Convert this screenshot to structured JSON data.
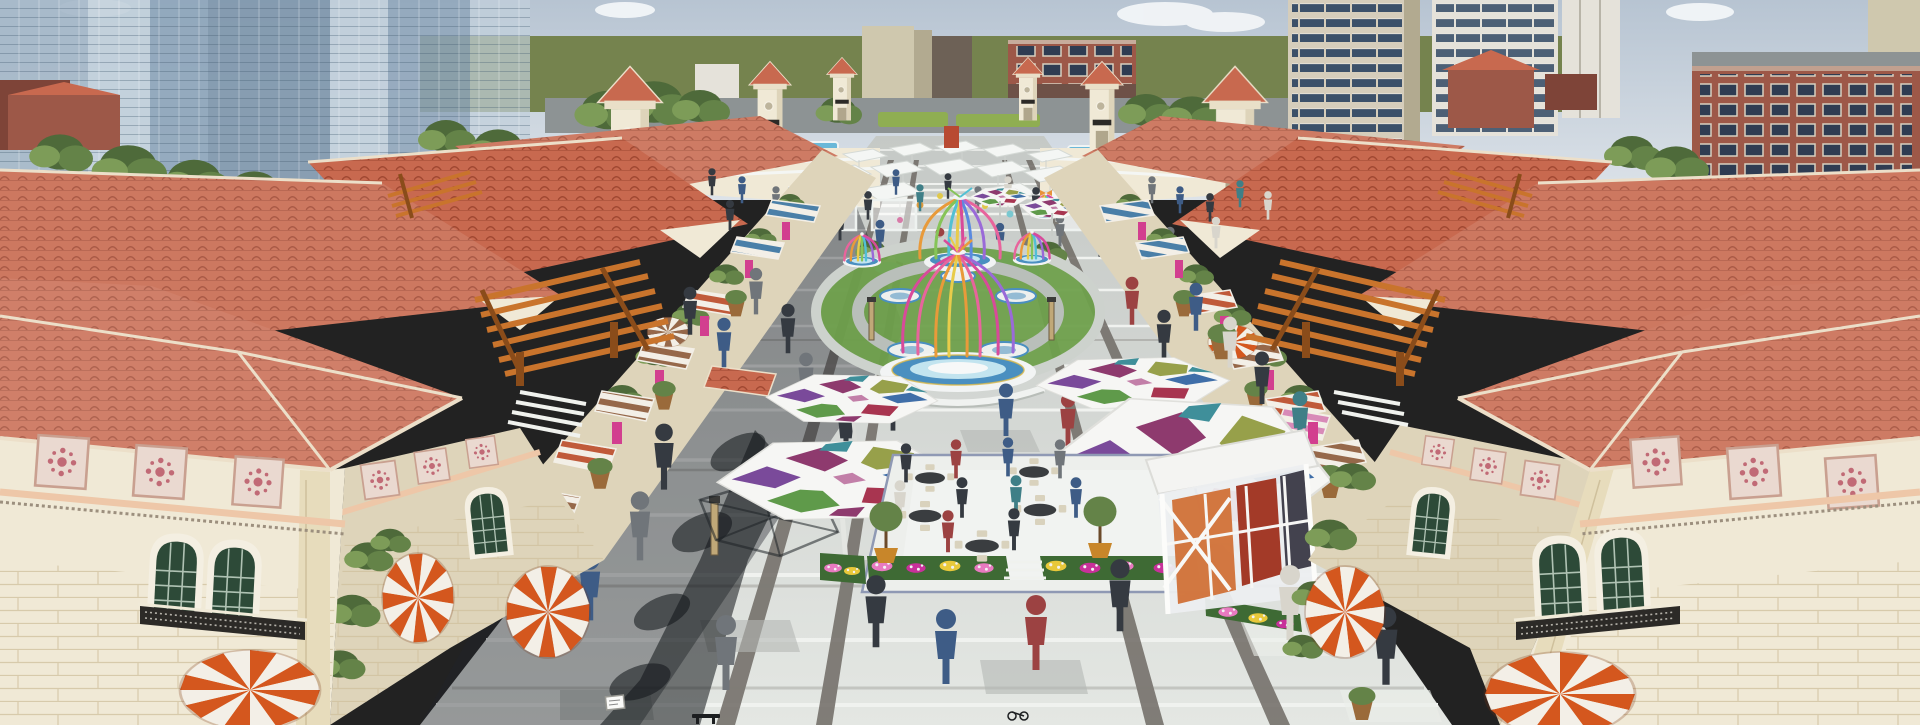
{
  "scene": {
    "type": "3d-architectural-rendering",
    "description": "Aerial rendering of a Mediterranean-style pedestrian shopping street: red tile roofs, central plaza with colorful hexagonal stained-glass canopies, rainbow birdcage pavilions on blue circular bases, striped dome awnings, cafe terrace with flower beds, city high-rises behind"
  },
  "colors": {
    "sky-top": "#b7c4d2",
    "sky-low": "#dde3e9",
    "cloud": "#f5f7f9",
    "field": "#75834e",
    "road": "#8d9394",
    "glass-a": "#a6b9c9",
    "glass-b": "#c2d0dc",
    "glass-c": "#8ea5ba",
    "glass-d": "#7d95ab",
    "tree-1": "#4e6a3a",
    "tree-2": "#648348",
    "tree-3": "#7d9c58",
    "tan": "#cfc8ae",
    "tan-shade": "#b2aa90",
    "brown": "#6d6156",
    "brick": "#9d5848",
    "brick-dark": "#7e4438",
    "win-dark": "#2e4662",
    "concrete": "#e5e2da",
    "wall-right": "#d5cdbb",
    "roof-base": "#c8694f",
    "roof-line": "#a14832",
    "roof-trim": "#ecdfc9",
    "cream": "#f0e9d6",
    "cream-shade": "#ded4ba",
    "cream-2": "#e9dfc8",
    "cornice": "#eec7a8",
    "frieze": "#9c8f7e",
    "stone": "#e7dcbc",
    "stone-line": "#cfc09c",
    "orn-bg": "#ead9d0",
    "orn-dot": "#c16a76",
    "orn-frame": "#c9a090",
    "win-green": "#2d4a38",
    "win-frame": "#f4efe2",
    "iron": "#2c2a27",
    "awn-orange": "#d4571e",
    "awn-white": "#f3efe7",
    "awn-blue": "#4a7fa8",
    "awn-red": "#c05a3a",
    "awn-brown": "#96684a",
    "awn-pink": "#d88ab8",
    "pergola": "#c9742c",
    "pergola-dark": "#8a4c1a",
    "pave-top": "#c5c9c6",
    "pave-bottom": "#e4e7e3",
    "pave-band": "#f0f2ef",
    "pave-accent": "#6e6a64",
    "pave-dk": "#b4b8b4",
    "pave-lt": "#eceeea",
    "shadow": "rgba(32,36,42,0.40)",
    "shadow-deep": "rgba(16,20,24,0.55)",
    "hex-frame": "#f6f6f4",
    "hex-1": "#8e3a6e",
    "hex-2": "#97a04a",
    "hex-3": "#3f6ea8",
    "hex-4": "#a83550",
    "hex-5": "#5f9a4a",
    "hex-6": "#7a4a9a",
    "hex-7": "#c27fa8",
    "hex-8": "#3f8f9a",
    "cage-white": "#f2f4f4",
    "cage-blue": "#4a8fc0",
    "cage-aqua": "#c2e4ef",
    "lawn": "#6fa04c",
    "lawn-2": "#8fae52",
    "gold": "#d8b84a",
    "rib-1": "#e8649c",
    "rib-2": "#e89a3a",
    "rib-3": "#e8cc4a",
    "rib-4": "#86c458",
    "rib-5": "#52c0d4",
    "rib-6": "#9a6ad8",
    "rib-7": "#d84a9a",
    "rib-8": "#5a8ae0",
    "deck": "#edefec",
    "deck-edge": "#8f99b4",
    "flower-green": "#3e6a34",
    "flower-pink": "#e87ac0",
    "flower-magenta": "#c8309a",
    "flower-yellow": "#e8c83a",
    "flower-white": "#f2f2f2",
    "pot": "#c8862a",
    "table": "#3a3d40",
    "chair": "#d9d2bd",
    "pav-orange": "#cf6a2e",
    "pav-red": "#a33a28",
    "pav-dark": "#43424e",
    "person-a": "#353a41",
    "person-b": "#3e5c86",
    "person-c": "#70757a",
    "person-d": "#d8d5cc",
    "person-e": "#9c4242",
    "person-f": "#3f7f87",
    "kiosk": "#b84a32",
    "pool": "#6ab8d8",
    "sign": "#d23f8f",
    "post-wood": "#c0a878",
    "aqua-shrub": "#8fd0d8",
    "wire": "#1e2226",
    "pebble": "#b7b2a7",
    "pebble-dot": "#9b968c",
    "step": "#f0f2ee",
    "sign-white": "#fafaf8"
  }
}
